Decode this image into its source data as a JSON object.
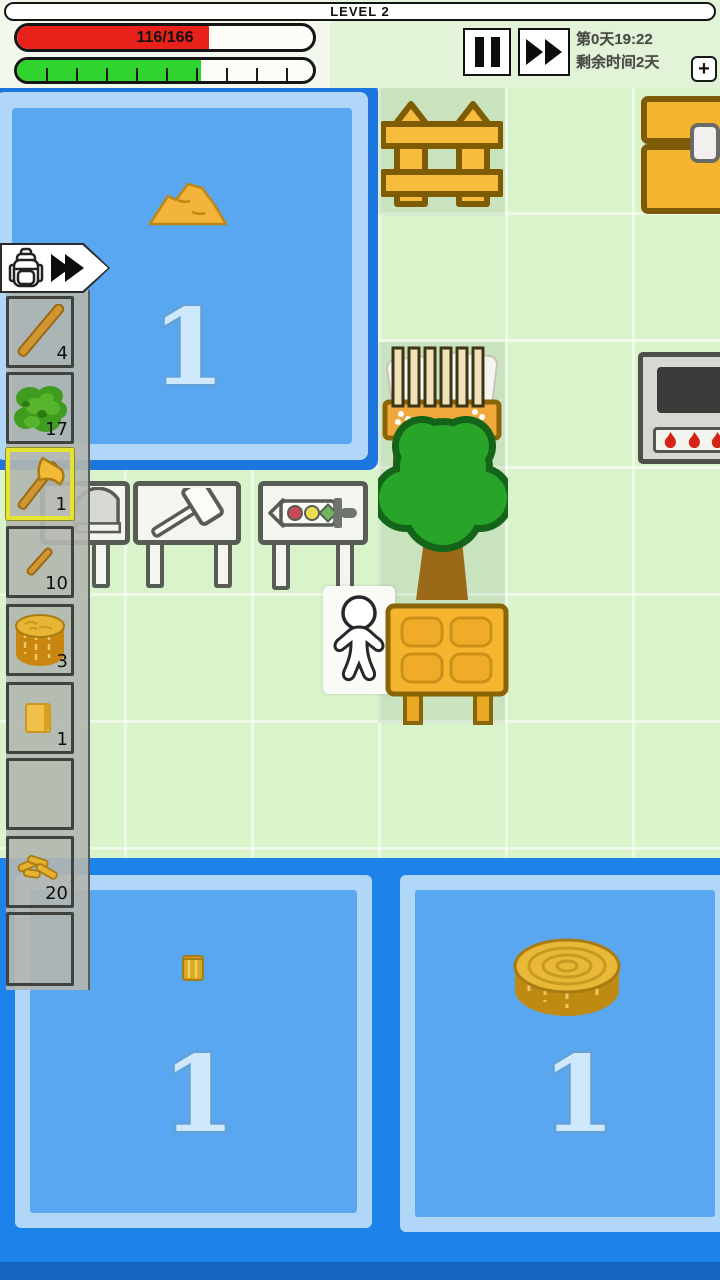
{
  "header": {
    "level_label": "LEVEL 2",
    "hp_bar": {
      "value_text": "116/166",
      "fill_percent": 65,
      "fill_color": "#e8221a"
    },
    "energy_bar": {
      "fill_percent": 62,
      "fill_color": "#2fd42f",
      "segments": 10
    },
    "clock": {
      "line1": "第0天19:22",
      "line2": "剩余时间2天"
    },
    "buttons": {
      "pause_icon": "pause",
      "fast_forward_icon": "double-play",
      "add_label": "+"
    }
  },
  "inventory": {
    "badge": {
      "backpack_icon": "backpack",
      "expand_icon": "double-play"
    },
    "slots": [
      {
        "item": "stick",
        "count": "4",
        "selected": false
      },
      {
        "item": "leaves",
        "count": "17",
        "selected": false
      },
      {
        "item": "axe",
        "count": "1",
        "selected": true
      },
      {
        "item": "small-stick",
        "count": "10",
        "selected": false
      },
      {
        "item": "log",
        "count": "3",
        "selected": false
      },
      {
        "item": "plank",
        "count": "1",
        "selected": false
      },
      {
        "item": "empty",
        "count": "",
        "selected": false
      },
      {
        "item": "branches",
        "count": "20",
        "selected": false
      },
      {
        "item": "empty",
        "count": "",
        "selected": false
      }
    ]
  },
  "map": {
    "ponds": [
      {
        "id": "top-left",
        "label": "1",
        "contains": "sand-mound"
      },
      {
        "id": "bottom-left",
        "label": "1",
        "contains": "small-wood-piece"
      },
      {
        "id": "bottom-right",
        "label": "1",
        "contains": "wood-log"
      }
    ],
    "objects": [
      "fence",
      "chest",
      "crib",
      "tree",
      "stove",
      "crafting-table-dome",
      "crafting-table-hammer",
      "crafting-table-sword",
      "character",
      "cabinet"
    ]
  },
  "colors": {
    "field_green": "#d9f4cb",
    "pond_fill": "#59a7f0",
    "pond_border_light": "#b0d7f7",
    "pond_border_dark": "#1d76dd",
    "bottom_water": "#1d82ea",
    "wood_orange": "#f5b52e",
    "wood_outline": "#8a6508",
    "selected_slot": "#e6e332"
  }
}
